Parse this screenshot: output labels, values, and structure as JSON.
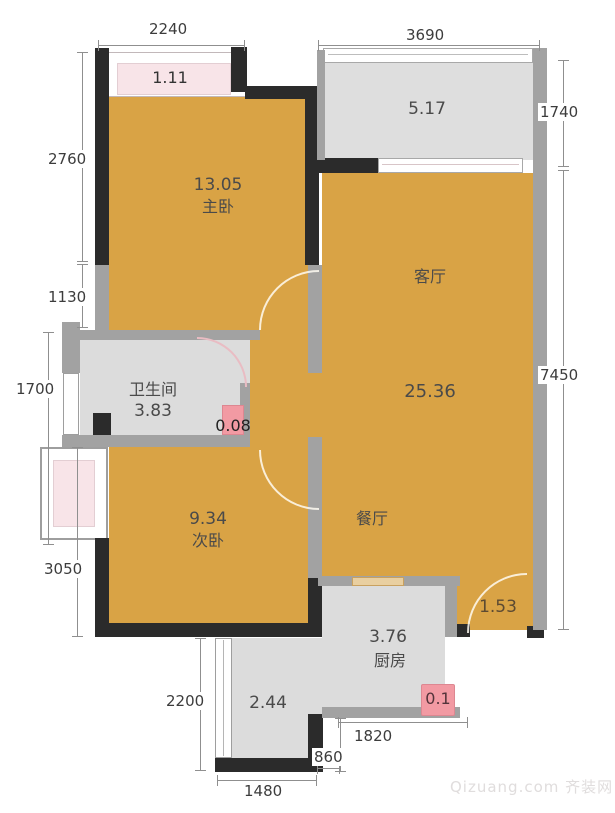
{
  "plan": {
    "rooms": {
      "master_bedroom": {
        "name": "主卧",
        "area": "13.05"
      },
      "living_room": {
        "name": "客厅",
        "area": "25.36"
      },
      "dining_room": {
        "name": "餐厅"
      },
      "bathroom": {
        "name": "卫生间",
        "area": "3.83"
      },
      "second_bedroom": {
        "name": "次卧",
        "area": "9.34"
      },
      "kitchen": {
        "name": "厨房",
        "area": "3.76"
      },
      "balcony_master": {
        "area": "1.11"
      },
      "balcony_living": {
        "area": "5.17"
      },
      "shaft_bathroom": {
        "area": "0.08"
      },
      "entry": {
        "area": "1.53"
      },
      "shaft_kitchen": {
        "area": "0.1"
      },
      "corridor": {
        "area": "2.44"
      }
    },
    "dimensions_mm": {
      "top_left": "2240",
      "top_right": "3690",
      "right_top": "1740",
      "right_main": "7450",
      "left_1": "2760",
      "left_2": "1130",
      "left_3": "1700",
      "left_4": "3050",
      "corridor": "2200",
      "bottom_left": "1480",
      "bottom_kitchen": "1820",
      "bottom_small": "860"
    },
    "watermark": "Qizuang.com 齐装网",
    "colors": {
      "room_fill": "#d9a345",
      "utility_fill": "#dcdcdc",
      "balcony_pink": "#f8e4e8",
      "badge_pink": "#f29aa3",
      "wall_dark": "#2b2b2b",
      "wall_gray": "#a2a2a2"
    }
  }
}
